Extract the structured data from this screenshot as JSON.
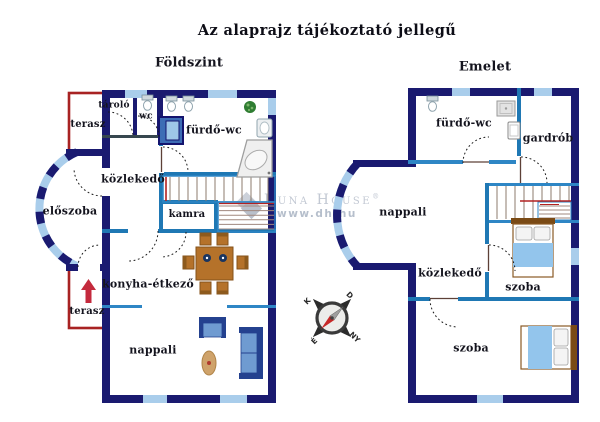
{
  "title": "Az alaprajz tájékoztató jellegű",
  "floors": {
    "ground": {
      "name": "Földszint",
      "rooms": {
        "tarolo": "tároló",
        "wc": "wc",
        "terasz_felso": "terasz",
        "furdo_wc": "fürdő-wc",
        "kozlekedo": "közlekedő",
        "eloszoba": "előszoba",
        "kamra": "kamra",
        "konyha_etkezo": "konyha-étkező",
        "terasz_also": "terasz",
        "nappali": "nappali"
      }
    },
    "emelet": {
      "name": "Emelet",
      "rooms": {
        "furdo_wc": "fürdő-wc",
        "gardrob": "gardrób",
        "nappali": "nappali",
        "kozlekedo": "közlekedő",
        "szoba_1": "szoba",
        "szoba_2": "szoba"
      }
    }
  },
  "watermark": {
    "brand": "Duna House",
    "registered": "®",
    "url": "www.dh.hu"
  },
  "compass": {
    "north": "É",
    "south": "D",
    "east": "K",
    "west": "NY"
  },
  "colors": {
    "outer_wall": "#1a1a70",
    "inner_wall": "#1f78b4",
    "window": "#a9cdeb",
    "terrace": "#a82222",
    "stair_accent": "#b22222",
    "furniture_blue": "#3d6db5",
    "furniture_wood": "#b5722a",
    "bed_blanket": "#93c5ec"
  }
}
